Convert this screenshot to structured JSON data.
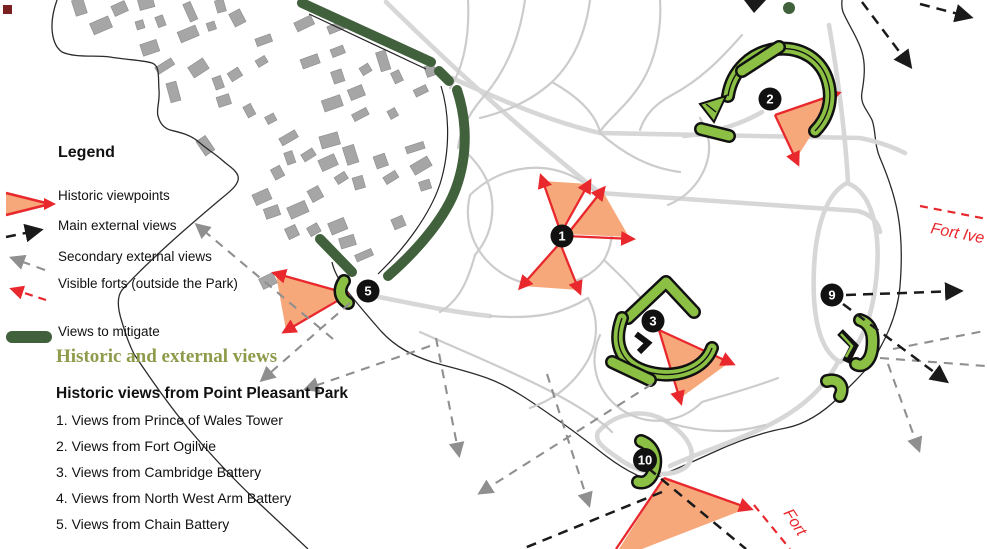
{
  "legend": {
    "title": "Legend",
    "items": [
      {
        "key": "historic-viewpoints",
        "label": "Historic viewpoints"
      },
      {
        "key": "main-external-views",
        "label": "Main external views"
      },
      {
        "key": "secondary-external-views",
        "label": "Secondary external views"
      },
      {
        "key": "visible-forts",
        "label": "Visible forts (outside the Park)"
      },
      {
        "key": "views-to-mitigate",
        "label": "Views to mitigate"
      }
    ]
  },
  "sections": {
    "heading": "Historic and external views",
    "subheading": "Historic views from Point Pleasant Park",
    "items": [
      "1. Views from Prince of Wales Tower",
      "2. Views from Fort Ogilvie",
      "3. Views from Cambridge Battery",
      "4. Views from North West Arm Battery",
      "5. Views from Chain Battery"
    ]
  },
  "map": {
    "viewpoints": [
      {
        "n": "1"
      },
      {
        "n": "2"
      },
      {
        "n": "3"
      },
      {
        "n": "5"
      },
      {
        "n": "9"
      },
      {
        "n": "10"
      }
    ],
    "labels": {
      "fort_right": "Fort Ive",
      "fort_bottom": "Fort"
    },
    "colors": {
      "viewpoint_cone": "#F7A87B",
      "arrow_red": "#E8282D",
      "views_to_mitigate_green": "#41603C",
      "fort_fill_green": "#8CC044",
      "heading_olive": "#8D9B4A",
      "path_gray": "#CCCCCC",
      "secondary_arrow_gray": "#8F8F8F",
      "main_arrow_black": "#1A1A1A"
    }
  }
}
